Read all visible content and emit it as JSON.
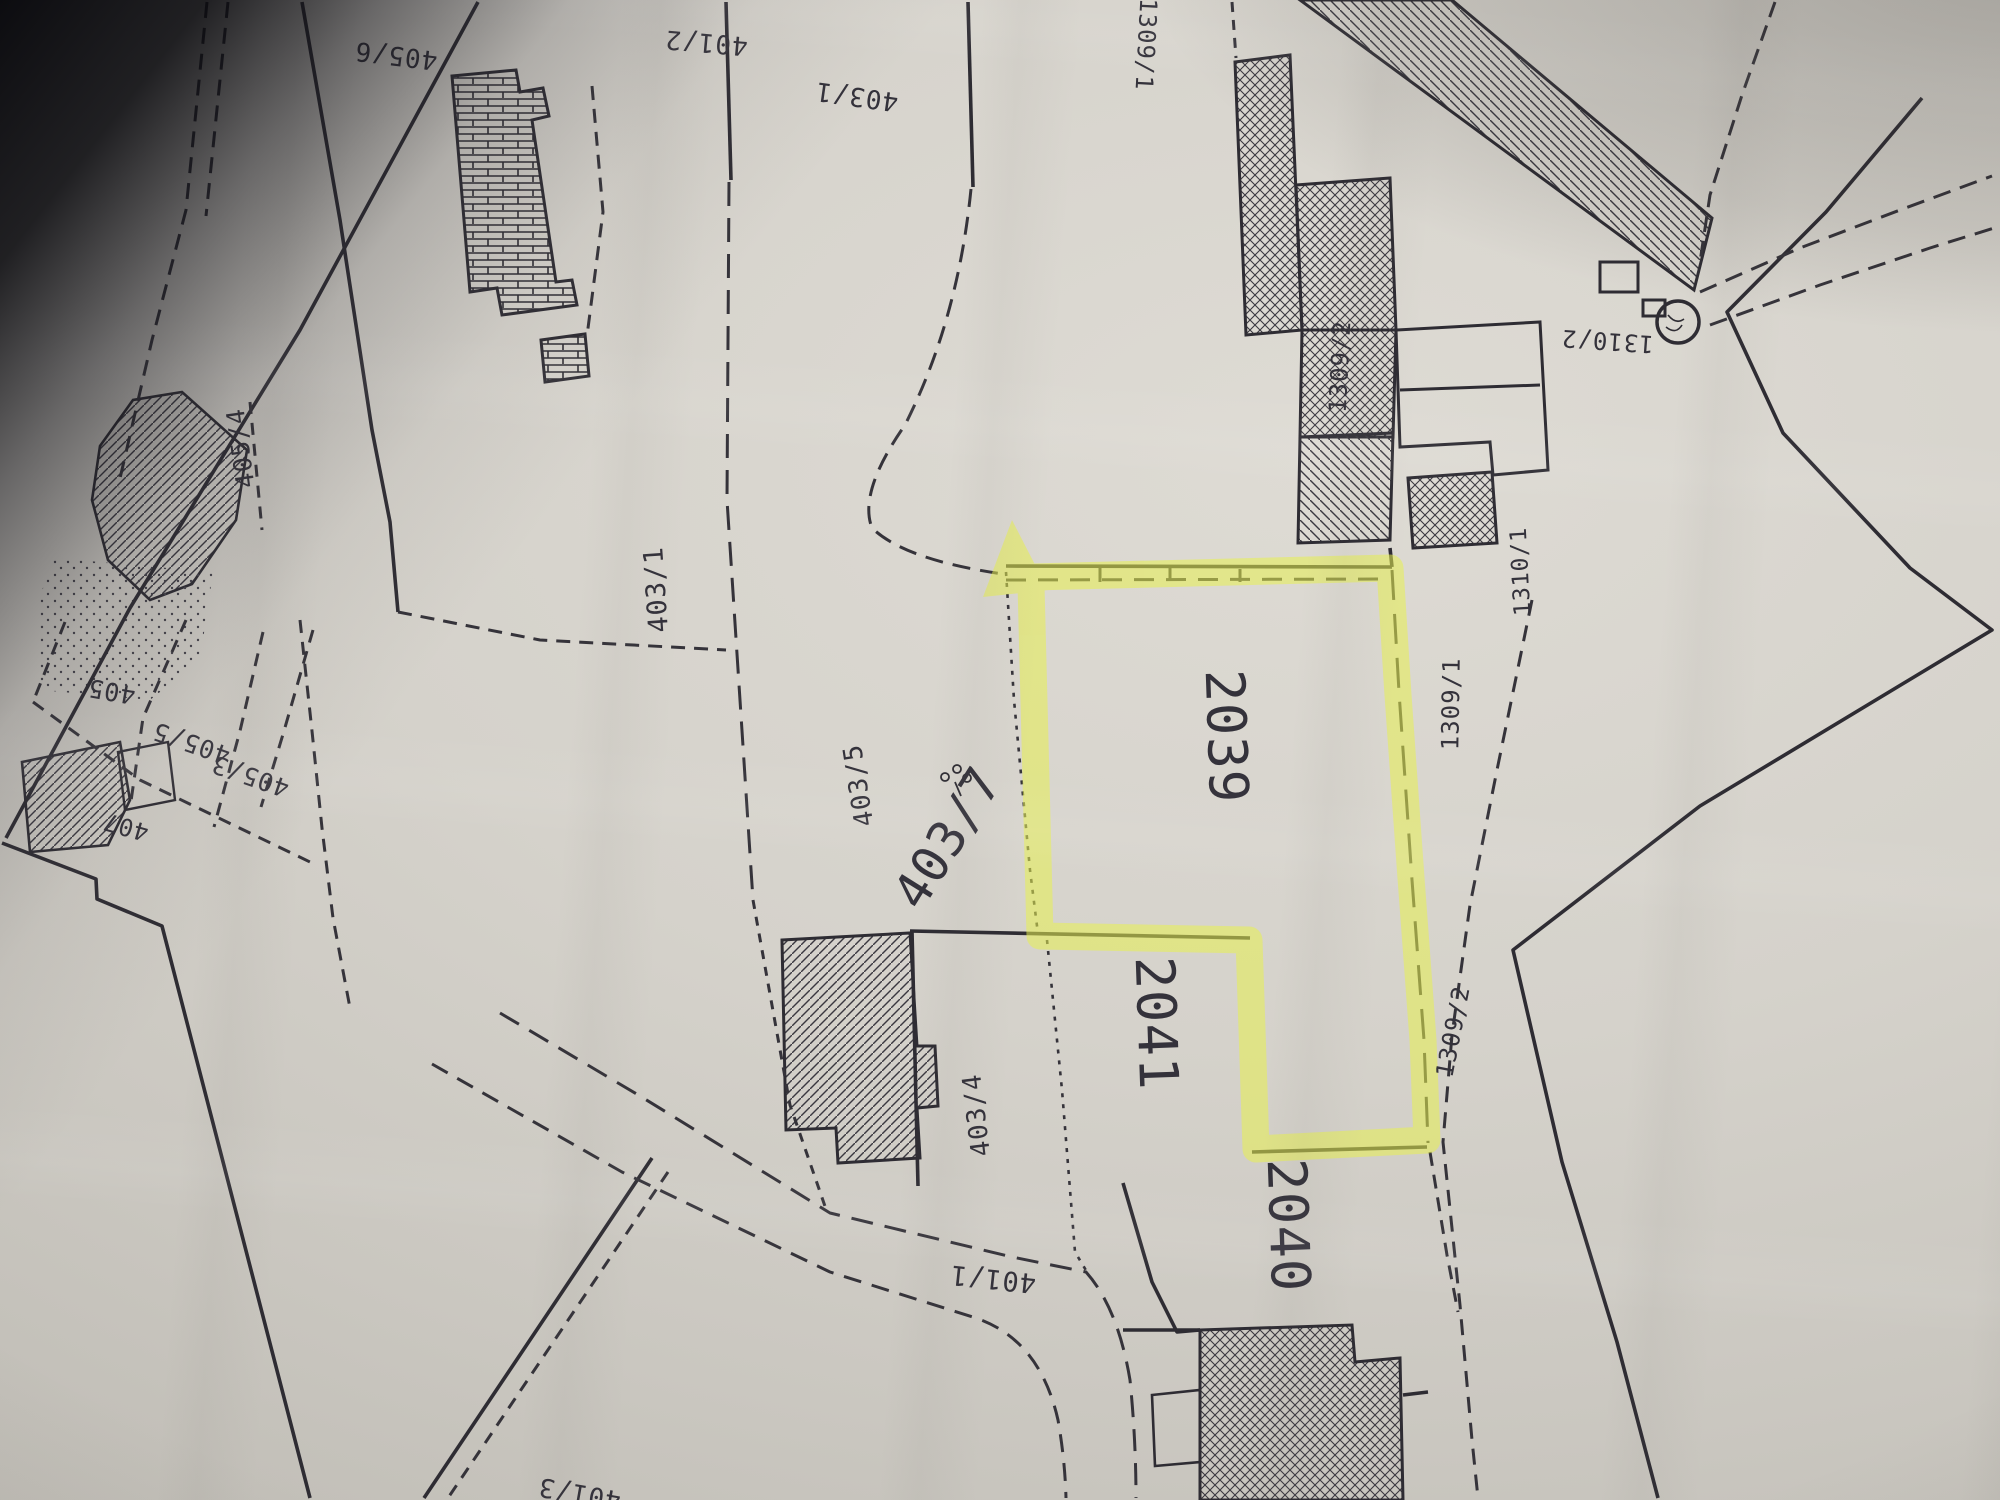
{
  "meta": {
    "kind": "photographed cadastral parcel map (photocopy)",
    "highlighted_parcel": "2039",
    "highlight_color": "#e8f050",
    "ink_color": "#2e2c33",
    "paper_color": "#d3d0c9"
  },
  "labels": {
    "p405_6": "405/6",
    "p401_2": "401/2",
    "p403_1_top": "403/1",
    "p1309_1_top": "1309/1",
    "p405_4": "405/4",
    "p403_1_mid": "403/1",
    "p403_5": "403/5",
    "p403_7": "403/7",
    "p2039": "2039",
    "p1309_2_bldg": "1309/2",
    "p1310_2": "1310/2",
    "p1310_1": "1310/1",
    "p1309_1_east": "1309/1",
    "p1309_2_south": "1309/2",
    "p2041": "2041",
    "p403_4": "403/4",
    "p2040": "2040",
    "p401_1": "401/1",
    "p405": "405",
    "p405_5": "405/5",
    "p405_3": "405/3",
    "p407": "407",
    "p401_3": "401/3"
  }
}
